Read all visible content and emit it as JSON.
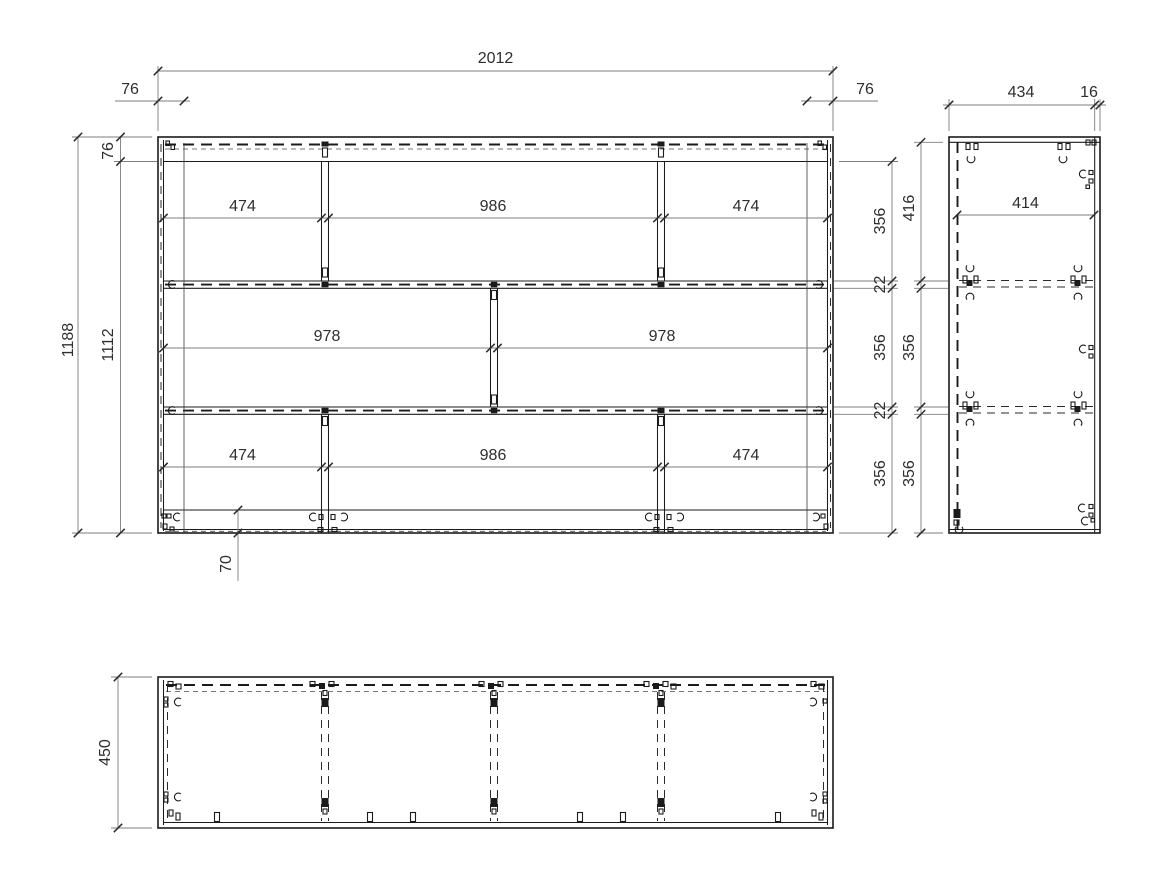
{
  "dims": {
    "front": {
      "overall_width": "2012",
      "edge_offset_left": "76",
      "edge_offset_right": "76",
      "overall_height": "1188",
      "inner_height": "1112",
      "top_rail_height": "76",
      "top_row_widths": [
        "474",
        "986",
        "474"
      ],
      "middle_row_widths": [
        "978",
        "978"
      ],
      "bottom_row_widths": [
        "474",
        "986",
        "474"
      ],
      "right_height_chain": [
        "356",
        "22",
        "356",
        "22",
        "356"
      ],
      "plinth_height": "70"
    },
    "side": {
      "body_depth": "434",
      "front_panel_thickness": "16",
      "inner_depth": "414",
      "height_chain": [
        "416",
        "356",
        "356"
      ]
    },
    "top": {
      "overall_depth": "450"
    }
  }
}
